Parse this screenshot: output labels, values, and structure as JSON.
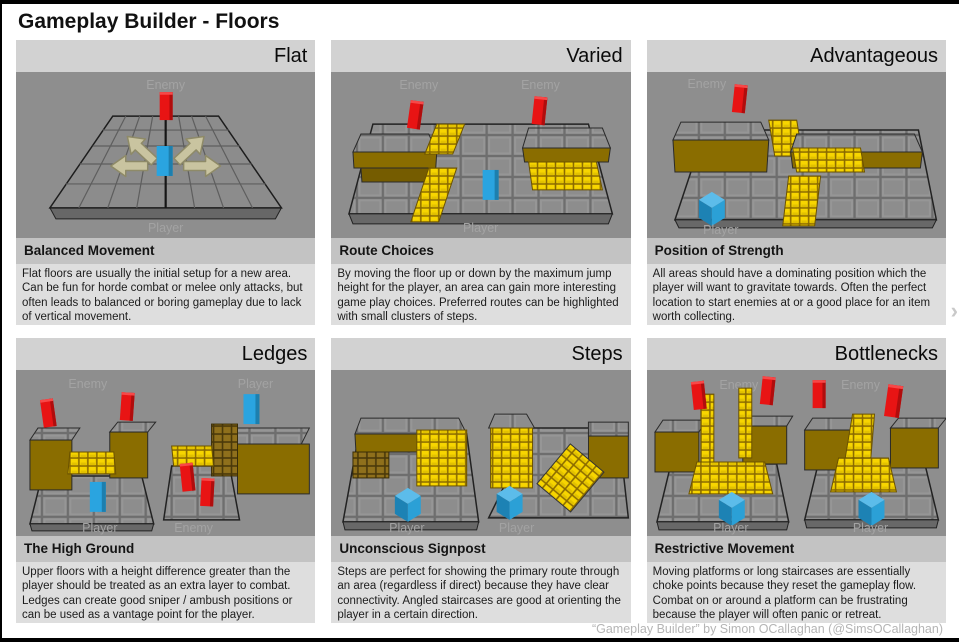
{
  "page": {
    "title": "Gameplay Builder - Floors",
    "credit": "“Gameplay Builder” by Simon OCallaghan (@SimsOCallaghan)"
  },
  "icons": {
    "next_chevron": "›"
  },
  "colors": {
    "enemy_red": "#e81414",
    "player_blue": "#2aa4e0",
    "step_yellow": "#f7d500",
    "platform_gold": "#8a6d00",
    "floor_gray": "#8e8e8e"
  },
  "panels": [
    {
      "id": "flat",
      "title": "Flat",
      "heading": "Balanced Movement",
      "body": "Flat floors are usually the initial setup for a new area. Can be fun for horde combat or melee only attacks, but often leads to balanced or boring gameplay due to lack of vertical movement.",
      "labels": [
        "Enemy",
        "Player"
      ]
    },
    {
      "id": "varied",
      "title": "Varied",
      "heading": "Route Choices",
      "body": "By moving the floor up or down by the maximum jump height for the player, an area can gain more interesting game play choices. Preferred routes can be highlighted with small clusters of steps.",
      "labels": [
        "Enemy",
        "Enemy",
        "Player"
      ]
    },
    {
      "id": "advantageous",
      "title": "Advantageous",
      "heading": "Position of Strength",
      "body": "All areas should have a dominating position which the player will want to gravitate towards. Often the perfect location to start enemies at or a good place for an item worth collecting.",
      "labels": [
        "Enemy",
        "Player"
      ]
    },
    {
      "id": "ledges",
      "title": "Ledges",
      "heading": "The High Ground",
      "body": "Upper floors with a height difference greater than the player should be treated as an extra layer to combat. Ledges can create good sniper / ambush positions or can be used as a vantage point for the player.",
      "labels": [
        "Enemy",
        "Player",
        "Player",
        "Enemy"
      ]
    },
    {
      "id": "steps",
      "title": "Steps",
      "heading": "Unconscious Signpost",
      "body": "Steps are perfect for showing the primary route through an area (regardless if direct) because they have clear connectivity. Angled staircases are good at orienting the player in a certain direction.",
      "labels": [
        "Player",
        "Player"
      ]
    },
    {
      "id": "bottlenecks",
      "title": "Bottlenecks",
      "heading": "Restrictive Movement",
      "body": "Moving platforms or long staircases are essentially choke points because they reset the gameplay flow. Combat on or around a platform can be frustrating because the player will often panic or retreat.",
      "labels": [
        "Enemy",
        "Enemy",
        "Player",
        "Player"
      ]
    }
  ]
}
